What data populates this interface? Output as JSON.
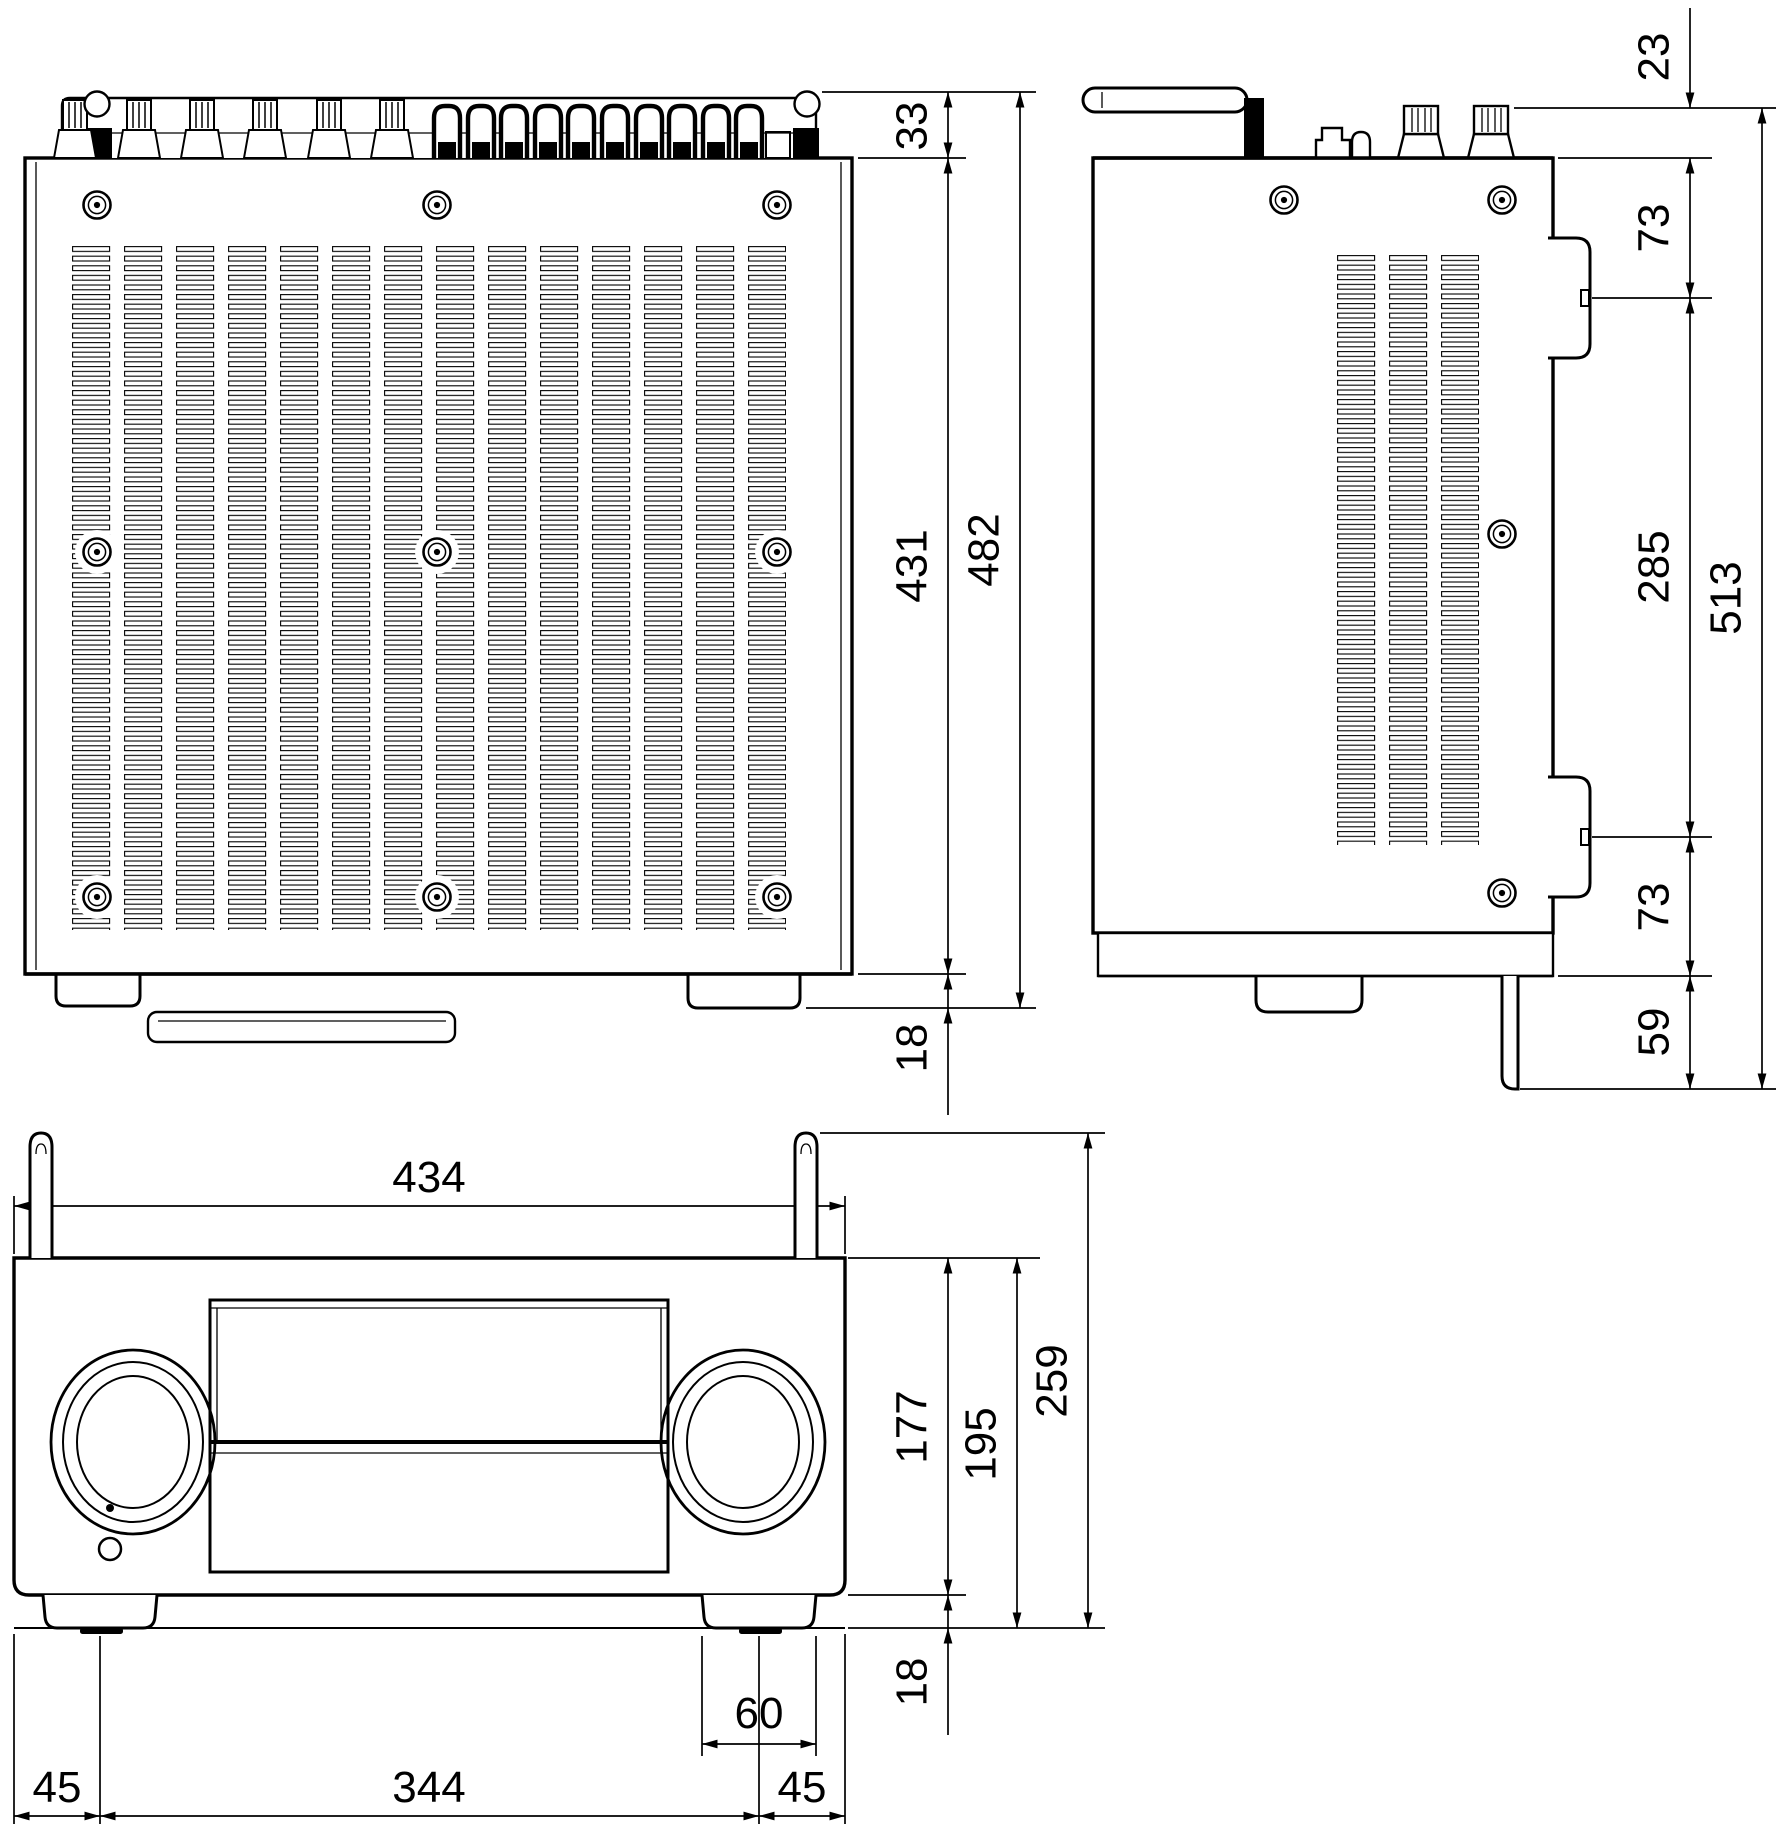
{
  "drawing": {
    "type": "orthographic-dimension-drawing",
    "subject": "AV receiver outline drawing (top, side and front views)",
    "units_implied": "mm",
    "colors": {
      "line": "#000000",
      "background": "#ffffff"
    }
  },
  "dims": {
    "top": {
      "rear_terminal_depth": "33",
      "chassis_depth": "431",
      "total_depth": "482",
      "front_knob_projection": "18"
    },
    "side": {
      "antenna_clearance": "23",
      "top_to_upper_mount": "73",
      "mount_spacing": "285",
      "total_depth_with_stand": "513",
      "lower_mount_to_base": "73",
      "base_plate_drop": "59"
    },
    "front": {
      "width": "434",
      "panel_height": "177",
      "chassis_height": "195",
      "total_height": "259",
      "foot_height": "18",
      "foot_width": "60",
      "left_foot_offset": "45",
      "foot_spacing": "344",
      "right_foot_offset": "45"
    }
  }
}
